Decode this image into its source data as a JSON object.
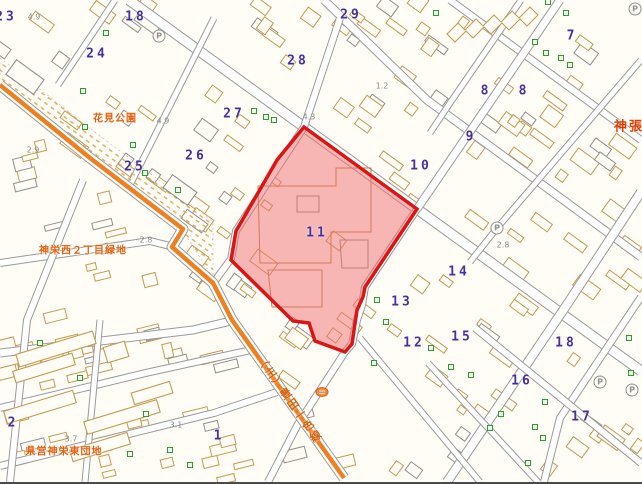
{
  "map": {
    "colors": {
      "background": "#fffdf6",
      "building": "#c49a50",
      "building_gray": "#8f8f8f",
      "road_casing": "#9a9a9a",
      "orange_road": "#ef8020",
      "hatch": "#d8ae62",
      "parcel_fill": "#f07070",
      "parcel_border": "#dc1414",
      "block_number": "#46309b",
      "label_orange": "#e2600e",
      "green_symbol": "#2aa02a",
      "gray_text": "#8a8a8a"
    },
    "block_numbers": [
      {
        "label": "23",
        "x": 6,
        "y": 17
      },
      {
        "label": "18",
        "x": 136,
        "y": 17
      },
      {
        "label": "24",
        "x": 97,
        "y": 54
      },
      {
        "label": "29",
        "x": 351,
        "y": 15
      },
      {
        "label": "28",
        "x": 298,
        "y": 61
      },
      {
        "label": "27",
        "x": 234,
        "y": 114
      },
      {
        "label": "7",
        "x": 572,
        "y": 36
      },
      {
        "label": "8",
        "x": 486,
        "y": 91
      },
      {
        "label": "8",
        "x": 524,
        "y": 91
      },
      {
        "label": "9",
        "x": 471,
        "y": 137
      },
      {
        "label": "25",
        "x": 135,
        "y": 167
      },
      {
        "label": "26",
        "x": 196,
        "y": 156
      },
      {
        "label": "10",
        "x": 421,
        "y": 166
      },
      {
        "label": "11",
        "x": 317,
        "y": 233
      },
      {
        "label": "14",
        "x": 459,
        "y": 272
      },
      {
        "label": "13",
        "x": 402,
        "y": 302
      },
      {
        "label": "12",
        "x": 414,
        "y": 343
      },
      {
        "label": "15",
        "x": 462,
        "y": 337
      },
      {
        "label": "18",
        "x": 566,
        "y": 343
      },
      {
        "label": "16",
        "x": 522,
        "y": 381
      },
      {
        "label": "17",
        "x": 582,
        "y": 417
      },
      {
        "label": "1",
        "x": 219,
        "y": 436
      },
      {
        "label": "2",
        "x": 13,
        "y": 423
      }
    ],
    "place_labels": [
      {
        "text": "花見公園",
        "x": 115,
        "y": 117,
        "big": false
      },
      {
        "text": "神栄西２丁目緑地",
        "x": 83,
        "y": 249,
        "big": false
      },
      {
        "text": "県営神栄東団地",
        "x": 64,
        "y": 450,
        "big": false
      },
      {
        "text": "神張",
        "x": 629,
        "y": 125,
        "big": true
      }
    ],
    "road_label": {
      "text": "（主）豊田一色線",
      "x": 289,
      "y": 400
    },
    "spot_elevations": [
      {
        "text": "4.9",
        "x": 34,
        "y": 17
      },
      {
        "text": "2.9",
        "x": 33,
        "y": 150
      },
      {
        "text": "4.9",
        "x": 163,
        "y": 121
      },
      {
        "text": "4.3",
        "x": 309,
        "y": 117
      },
      {
        "text": "1.2",
        "x": 382,
        "y": 86
      },
      {
        "text": "2.8",
        "x": 146,
        "y": 240
      },
      {
        "text": "2.8",
        "x": 503,
        "y": 245
      },
      {
        "text": "3.7",
        "x": 71,
        "y": 439
      },
      {
        "text": "3.1",
        "x": 176,
        "y": 425
      }
    ],
    "parking_icons": {
      "glyph": "P",
      "positions": [
        [
          159,
          36
        ],
        [
          635,
          9
        ],
        [
          497,
          228
        ],
        [
          600,
          382
        ],
        [
          632,
          390
        ]
      ]
    },
    "green_markers": [
      [
        83,
        91
      ],
      [
        85,
        127
      ],
      [
        106,
        33
      ],
      [
        133,
        145
      ],
      [
        145,
        173
      ],
      [
        178,
        190
      ],
      [
        254,
        111
      ],
      [
        266,
        117
      ],
      [
        274,
        120
      ],
      [
        436,
        13
      ],
      [
        548,
        2
      ],
      [
        566,
        13
      ],
      [
        535,
        42
      ],
      [
        546,
        53
      ],
      [
        561,
        58
      ],
      [
        570,
        65
      ],
      [
        40,
        343
      ],
      [
        80,
        378
      ],
      [
        146,
        414
      ],
      [
        130,
        454
      ],
      [
        170,
        450
      ],
      [
        190,
        465
      ],
      [
        377,
        300
      ],
      [
        374,
        363
      ],
      [
        386,
        322
      ],
      [
        431,
        348
      ],
      [
        451,
        367
      ],
      [
        471,
        375
      ],
      [
        490,
        428
      ],
      [
        501,
        414
      ],
      [
        535,
        427
      ],
      [
        543,
        438
      ],
      [
        528,
        463
      ],
      [
        545,
        402
      ],
      [
        629,
        338
      ],
      [
        631,
        373
      ]
    ],
    "parcel": {
      "number": "11",
      "points": [
        [
          304,
          127
        ],
        [
          417,
          209
        ],
        [
          365,
          287
        ],
        [
          363,
          297
        ],
        [
          357,
          310
        ],
        [
          352,
          344
        ],
        [
          345,
          352
        ],
        [
          315,
          341
        ],
        [
          309,
          323
        ],
        [
          293,
          321
        ],
        [
          231,
          260
        ],
        [
          236,
          231
        ],
        [
          277,
          160
        ]
      ]
    },
    "orange_road": {
      "pts": [
        [
          0,
          85
        ],
        [
          90,
          158
        ],
        [
          183,
          229
        ],
        [
          172,
          247
        ],
        [
          213,
          283
        ],
        [
          232,
          320
        ],
        [
          344,
          478
        ]
      ]
    },
    "streets": [
      {
        "pts": [
          [
            129,
            0
          ],
          [
            304,
            127
          ],
          [
            417,
            209
          ],
          [
            641,
            371
          ]
        ],
        "w": 9
      },
      {
        "pts": [
          [
            324,
            0
          ],
          [
            427,
            100
          ],
          [
            641,
            257
          ]
        ],
        "w": 7
      },
      {
        "pts": [
          [
            450,
            0
          ],
          [
            641,
            140
          ]
        ],
        "w": 6
      },
      {
        "pts": [
          [
            214,
            18
          ],
          [
            130,
            185
          ]
        ],
        "w": 5
      },
      {
        "pts": [
          [
            115,
            0
          ],
          [
            58,
            85
          ]
        ],
        "w": 5
      },
      {
        "pts": [
          [
            340,
            18
          ],
          [
            304,
            127
          ],
          [
            236,
            231
          ],
          [
            231,
            259
          ],
          [
            214,
            282
          ]
        ],
        "w": 6
      },
      {
        "pts": [
          [
            560,
            0
          ],
          [
            417,
            209
          ]
        ],
        "w": 7
      },
      {
        "pts": [
          [
            417,
            209
          ],
          [
            365,
            287
          ],
          [
            362,
            305
          ],
          [
            357,
            320
          ],
          [
            352,
            344
          ],
          [
            345,
            352
          ],
          [
            298,
            424
          ],
          [
            268,
            482
          ]
        ],
        "w": 6
      },
      {
        "pts": [
          [
            641,
            60
          ],
          [
            497,
            228
          ],
          [
            470,
            262
          ]
        ],
        "w": 5
      },
      {
        "pts": [
          [
            521,
            0
          ],
          [
            450,
            103
          ],
          [
            430,
            133
          ]
        ],
        "w": 5
      },
      {
        "pts": [
          [
            641,
            192
          ],
          [
            568,
            303
          ],
          [
            447,
            482
          ]
        ],
        "w": 8
      },
      {
        "pts": [
          [
            641,
            297
          ],
          [
            560,
            418
          ],
          [
            544,
            482
          ]
        ],
        "w": 6
      },
      {
        "pts": [
          [
            360,
            338
          ],
          [
            480,
            482
          ]
        ],
        "w": 5
      },
      {
        "pts": [
          [
            428,
            363
          ],
          [
            538,
            482
          ]
        ],
        "w": 5
      },
      {
        "pts": [
          [
            475,
            328
          ],
          [
            641,
            463
          ]
        ],
        "w": 6
      },
      {
        "pts": [
          [
            0,
            263
          ],
          [
            150,
            241
          ],
          [
            170,
            246
          ]
        ],
        "w": 6
      },
      {
        "pts": [
          [
            0,
            353
          ],
          [
            193,
            330
          ],
          [
            231,
            321
          ]
        ],
        "w": 7
      },
      {
        "pts": [
          [
            0,
            408
          ],
          [
            150,
            372
          ],
          [
            251,
            350
          ]
        ],
        "w": 6
      },
      {
        "pts": [
          [
            0,
            466
          ],
          [
            214,
            413
          ],
          [
            277,
            392
          ]
        ],
        "w": 6
      },
      {
        "pts": [
          [
            83,
            180
          ],
          [
            27,
            320
          ],
          [
            10,
            482
          ]
        ],
        "w": 6
      },
      {
        "pts": [
          [
            100,
            320
          ],
          [
            85,
            482
          ]
        ],
        "w": 5
      }
    ],
    "hatch_band": "0,58 92,130 196,208 213,222 213,278 183,231 90,158 0,85",
    "featured_buildings": [
      {
        "x": 56,
        "y": 349,
        "w": 80,
        "h": 13,
        "a": -17,
        "c": "tan"
      },
      {
        "x": 44,
        "y": 368,
        "w": 62,
        "h": 12,
        "a": -17,
        "c": "tan"
      },
      {
        "x": 40,
        "y": 407,
        "w": 72,
        "h": 13,
        "a": -17,
        "c": "tan"
      },
      {
        "x": 122,
        "y": 417,
        "w": 76,
        "h": 13,
        "a": -17,
        "c": "tan"
      },
      {
        "x": 152,
        "y": 393,
        "w": 40,
        "h": 12,
        "a": -17,
        "c": "tan"
      },
      {
        "x": 116,
        "y": 352,
        "w": 22,
        "h": 16,
        "a": -17,
        "c": "tan"
      },
      {
        "x": 100,
        "y": 447,
        "w": 60,
        "h": 12,
        "a": -17,
        "c": "tan"
      },
      {
        "x": 25,
        "y": 77,
        "w": 34,
        "h": 18,
        "a": 36,
        "c": "gray"
      },
      {
        "x": 180,
        "y": 190,
        "w": 30,
        "h": 16,
        "a": 36,
        "c": "gray"
      }
    ],
    "zigzag_building": "M447,34 l11,-11 l7,7 l11,-11 l7,7 l11,-11 l7,7 l11,-11 l7,7 l11,-11 l8,8 l-11,11 l-7,-7 l-11,11 l-7,-7 l-11,11 l-7,-7 l-11,11 l-7,-7 l-11,11 l-8,-8 z",
    "parcel_inner_paths": [
      {
        "d": "M258,186 L336,186 L336,168 L371,168 L371,232 L331,232 L331,263 L260,263 Z",
        "c": "#bf8040"
      },
      {
        "d": "M268,270 L322,270 L322,307 L272,307 Z",
        "c": "#bf8040"
      },
      {
        "d": "M297,196 L319,196 L319,212 L297,212 Z",
        "c": "#8a8a8a"
      },
      {
        "d": "M340,240 L368,240 L368,268 L342,268 Z",
        "c": "#8a8a8a"
      }
    ],
    "circle_symbol": {
      "x": 322,
      "y": 392
    }
  }
}
